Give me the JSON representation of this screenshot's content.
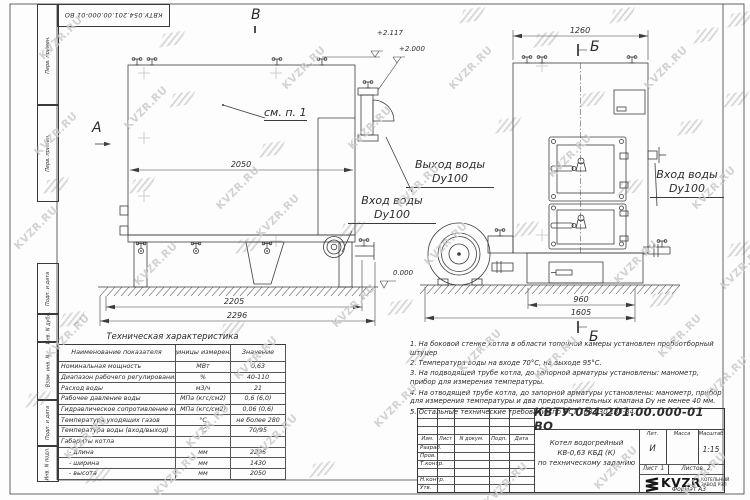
{
  "watermark": {
    "text": "KVZR.RU"
  },
  "frame": {
    "left_labels": [
      "Перв. примен.",
      "Перв. примен.",
      "Подп. и дата",
      "Инв. N дубл.",
      "Взам. инв. N",
      "Подп. и дата",
      "Инв. N подл."
    ],
    "format_label": "Формат  А3"
  },
  "drawing": {
    "view_labels": {
      "a": "А",
      "v": "В",
      "b_top": "Б",
      "b_bottom": "Б"
    },
    "callout_see_note": "см. п. 1",
    "elevations": {
      "top_outlet": "+2.117",
      "outlet_flange": "+2.000",
      "ground": "0.000"
    },
    "dims": {
      "d2050": "2050",
      "d2205": "2205",
      "d2296": "2296",
      "d1260": "1260",
      "d960": "960",
      "d1605": "1605"
    },
    "labels": {
      "outlet": {
        "line1": "Выход воды",
        "line2": "Dy100"
      },
      "inlet_left": {
        "line1": "Вход воды",
        "line2": "Dy100"
      },
      "inlet_right": {
        "line1": "Вход воды",
        "line2": "Dy100"
      }
    }
  },
  "tech_table": {
    "title": "Техническая характеристика",
    "headers": [
      "Наименование показателя",
      "Единицы измерения",
      "Значение"
    ],
    "rows": [
      [
        "Номинальная мощность",
        "МВт",
        "0,63"
      ],
      [
        "Диапазон рабочего регулирования",
        "%",
        "40-110"
      ],
      [
        "Расход воды",
        "м3/ч",
        "21"
      ],
      [
        "Рабочее давление воды",
        "МПа (кгс/см2)",
        "0,6 (6,0)"
      ],
      [
        "Гидравлическое сопротивление котла",
        "МПа (кгс/см2)",
        "0,06 (0,6)"
      ],
      [
        "Температура уходящих газов",
        "°С",
        "не более 280"
      ],
      [
        "Температура воды (вход/выход)",
        "°С",
        "70/95"
      ],
      [
        "Габариты котла",
        "",
        ""
      ],
      [
        "    - длина",
        "мм",
        "2296"
      ],
      [
        "    - ширина",
        "мм",
        "1430"
      ],
      [
        "    - высота",
        "мм",
        "2050"
      ]
    ]
  },
  "notes": {
    "items": [
      "1.  На боковой стенке котла в области топочной камеры установлен пробоотборный штуцер",
      "2.  Температура воды на входе 70°С, на выходе 95°С.",
      "3.  На подводящей трубе котла, до запорной арматуры установлены: манометр, прибор для измерения температуры.",
      "4.  На отводящей трубе котла, до запорной арматуры установлены: манометр, прибор для измерения температуры и два предохранительных клапана Dу не менее 40 мм.",
      "5.  Остальные технические требования по ОСТ 108.030.133-84."
    ]
  },
  "title_block": {
    "doc_number": "КВТУ.054.201.00.000-01 ВО",
    "rev_headers": [
      "Изм.",
      "Лист",
      "N докум.",
      "Подп.",
      "Дата"
    ],
    "row_labels": [
      "Разраб.",
      "Пров.",
      "Т.контр.",
      "",
      "Н.контр.",
      "Утв."
    ],
    "name_line1": "Котел водогрейный",
    "name_line2": "КВ-0,63 КБД (К)",
    "name_line3": "по техническому заданию",
    "lit_header": "Лит.",
    "mass_header": "Масса",
    "scale_header": "Масштаб",
    "lit_value": "И",
    "scale_value": "1:15",
    "sheet_label": "Лист",
    "sheet_value": "1",
    "sheets_label": "Листов",
    "sheets_value": "2",
    "logo_text": "KVZR",
    "logo_sub1": "КОТЕЛЬНЫЙ",
    "logo_sub2": "ЗАВОД РЭП"
  }
}
